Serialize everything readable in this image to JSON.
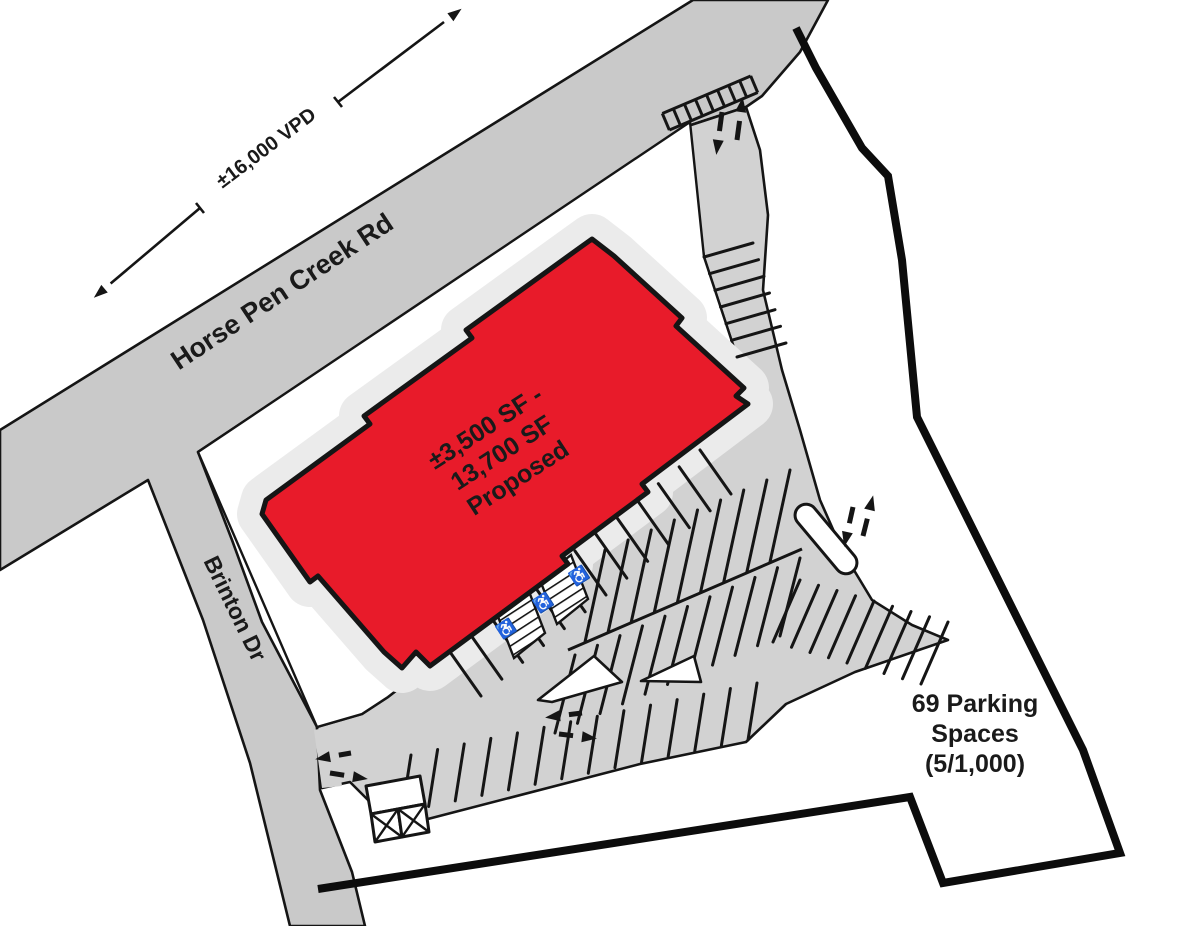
{
  "site_plan": {
    "road": {
      "name": "Horse Pen Creek Rd",
      "traffic_count": "±16,000 VPD"
    },
    "side_street": {
      "name": "Brinton Dr"
    },
    "building": {
      "label_line1": "±3,500 SF -",
      "label_line2": "13,700 SF",
      "label_line3": "Proposed",
      "fill_color": "#e81b2a"
    },
    "parking_note": {
      "line1": "69 Parking",
      "line2": "Spaces",
      "line3": "(5/1,000)"
    },
    "icons": {
      "accessible_parking": "♿"
    },
    "colors": {
      "road_gray": "#c9c9c9",
      "lot_gray": "#d2d2d2",
      "sidewalk_gray": "#ebebeb",
      "outline_black": "#151515",
      "boundary_black": "#0c0c0c",
      "building_red": "#e81b2a",
      "text_dark": "#1a1a1a"
    }
  }
}
